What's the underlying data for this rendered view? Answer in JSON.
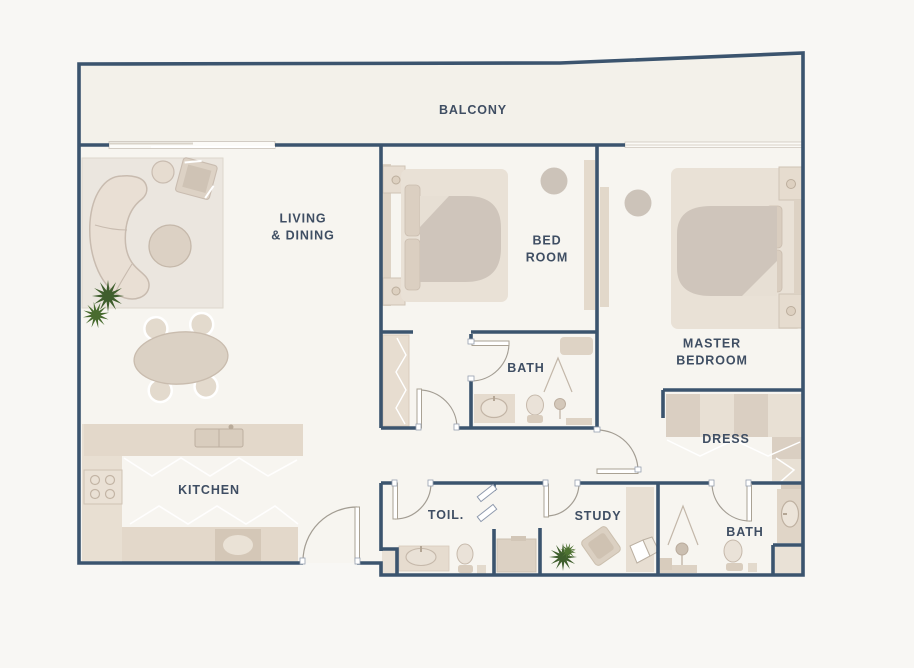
{
  "plan": {
    "type": "apartment-floor-plan",
    "rooms": {
      "balcony": {
        "label": "BALCONY"
      },
      "living_dining": {
        "label": "LIVING\n& DINING"
      },
      "bedroom": {
        "label": "BED\nROOM"
      },
      "master_bedroom": {
        "label": "MASTER\nBEDROOM"
      },
      "bedroom_bath": {
        "label": "BATH"
      },
      "dress": {
        "label": "DRESS"
      },
      "kitchen": {
        "label": "KITCHEN"
      },
      "toilet": {
        "label": "TOIL."
      },
      "study": {
        "label": "STUDY"
      },
      "master_bath": {
        "label": "BATH"
      }
    },
    "colors": {
      "wall": "#3b546e",
      "floor": "#f7f5f0",
      "balcony_floor": "#f3f1ea",
      "background": "#f8f7f4",
      "furniture_light": "#e8dfd3",
      "furniture_mid": "#d9cec1",
      "rug": "#ebe6df",
      "plant": "#3f5e2d",
      "label_text": "#3f4e63"
    }
  }
}
